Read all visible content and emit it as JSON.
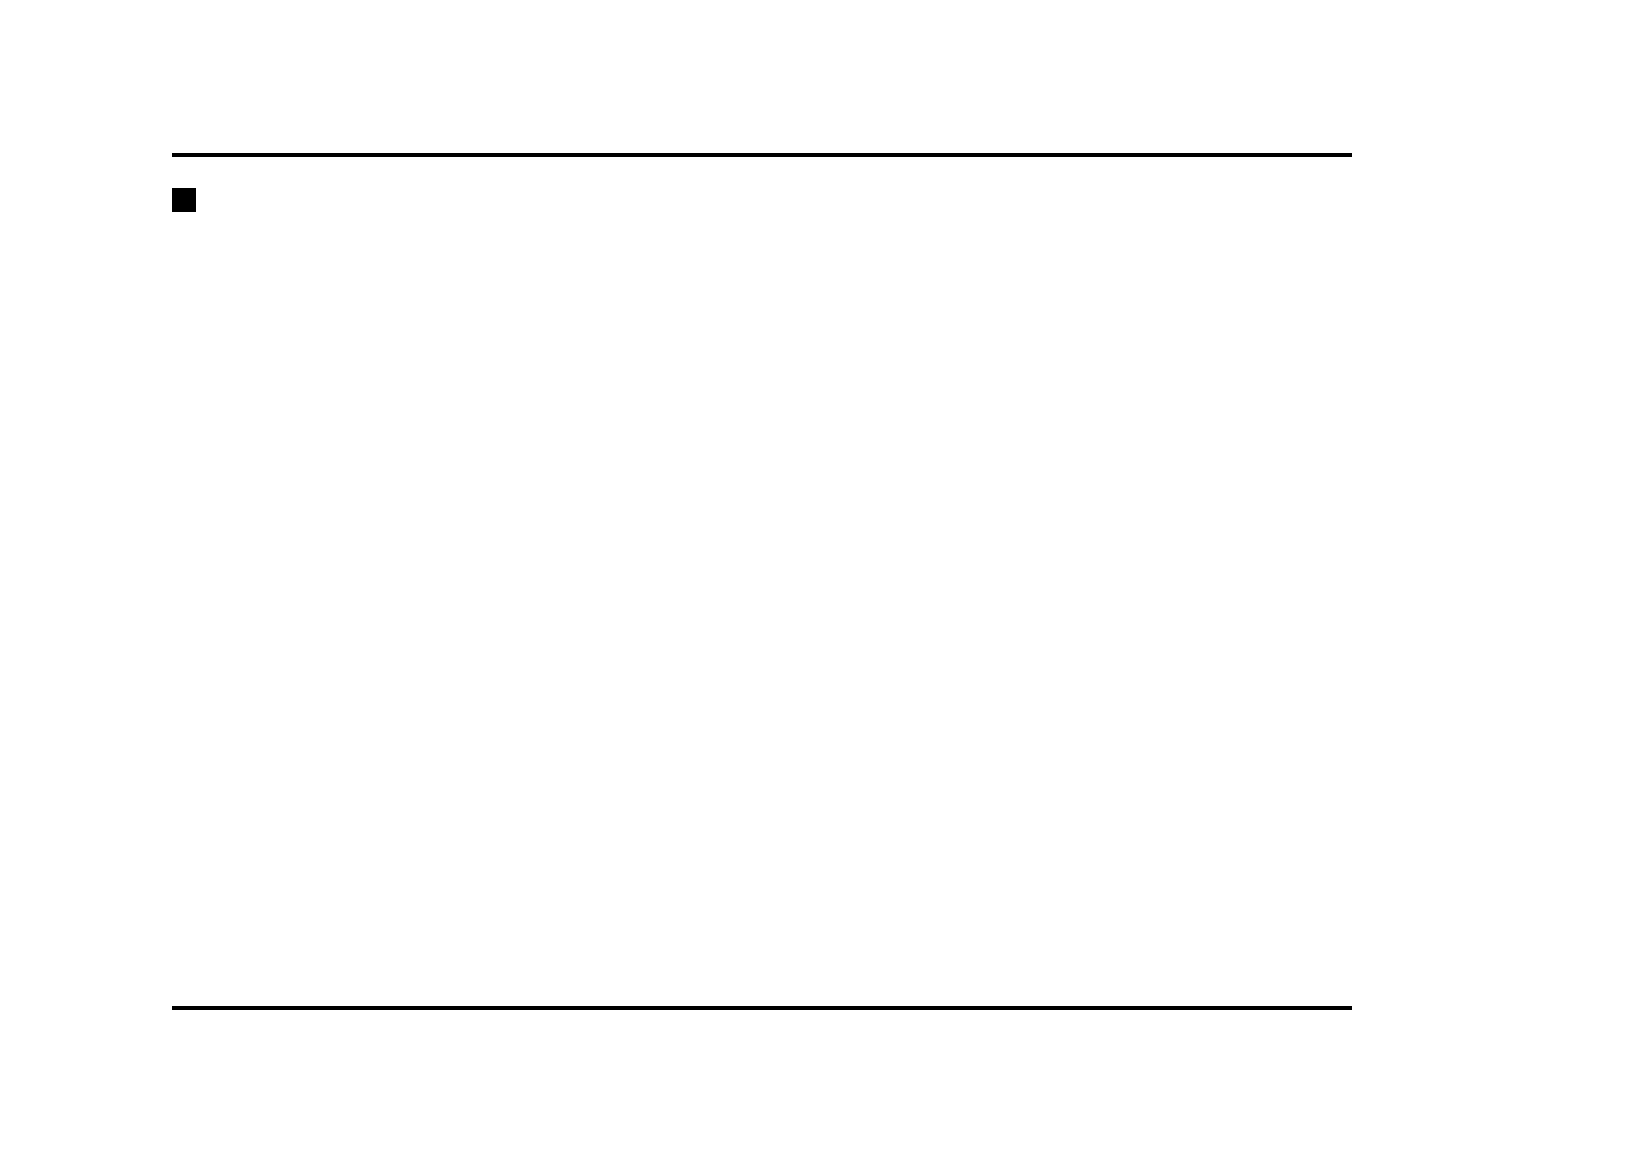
{
  "page": {
    "heading_marker": "■",
    "heading": "Combination meter",
    "subheading_marker": "▼",
    "subheading": "Non-turbo models",
    "page_number": "20",
    "figure_code": "UBF063BB"
  },
  "legend": [
    {
      "num": "1)",
      "lines": [
        "Fuel gauge (page 3-8)"
      ]
    },
    {
      "num": "2)",
      "lines": [
        "Speedometer (page 3-6)"
      ]
    },
    {
      "num": "3)",
      "lines": [
        "Tachometer (page 3-7)"
      ]
    },
    {
      "num": "4)",
      "lines": [
        "Temperature gauge (page 3-8)"
      ]
    },
    {
      "num": "5)",
      "lines": [
        "Clock setting knob (page 3-17)"
      ]
    },
    {
      "num": "6)",
      "lines": [
        "Clock and outside temperature",
        "indicator (page 3-17, 3-7)"
      ]
    },
    {
      "num": "7)",
      "lines": [
        "Selector lever position indicator",
        "(page 3-15)"
      ]
    },
    {
      "num": "8)",
      "lines": [
        "Trip meter A/B selection and trip",
        "meter reset knob (page 3-6)"
      ]
    },
    {
      "num": "9)",
      "lines": [
        "Trip meter and odometer (page",
        "3-6)"
      ]
    }
  ],
  "callouts": {
    "top": [
      "1",
      "2",
      "3",
      "4"
    ],
    "bottom": [
      "9",
      "8",
      "7",
      "6",
      "5"
    ]
  },
  "cluster": {
    "speedometer": {
      "numbers": [
        0,
        10,
        20,
        30,
        40,
        50,
        60,
        70,
        80,
        90,
        100,
        110,
        120
      ],
      "unit": "MPH",
      "inner_numbers": [
        0,
        20,
        40,
        60,
        80,
        100,
        120,
        140,
        160,
        180
      ],
      "inner_unit": "km/h"
    },
    "tachometer": {
      "numbers": [
        0,
        1,
        2,
        3,
        4,
        5,
        6,
        7
      ],
      "unit": "x1000r/min"
    },
    "gear_positions": [
      "P",
      "R",
      "N",
      "D",
      "3",
      "2",
      "1"
    ],
    "fuel_gauge": {
      "top": "F",
      "mid": "1/2",
      "bottom": "E"
    },
    "temp_gauge": {
      "top": "H",
      "bottom": "C"
    },
    "labels": {
      "brake": "BRAKE",
      "airbag": "AIR BAG",
      "abs": "ABS",
      "awd": "AWD",
      "check_engine": [
        "CHECK",
        "ENGINE"
      ],
      "at_oil_temp": [
        "AT OIL",
        "TEMP"
      ],
      "cruise_set": [
        "CRUISE",
        "SET"
      ],
      "security": "SECURITY",
      "fuel_door": "FUEL  DOOR"
    },
    "trip_display": {
      "trip_label_a": "TRIP",
      "a": "A",
      "trip_label_b": "TRIP",
      "b": "B",
      "trip_value": "000.0",
      "odometer": "000000"
    },
    "clock_display": {
      "time": "10:00",
      "out_label": "OUT.",
      "temp_label": "TEMP.",
      "temp_value": "100°F"
    },
    "clock_knob": {
      "minus": "-",
      "plus": "+"
    }
  }
}
